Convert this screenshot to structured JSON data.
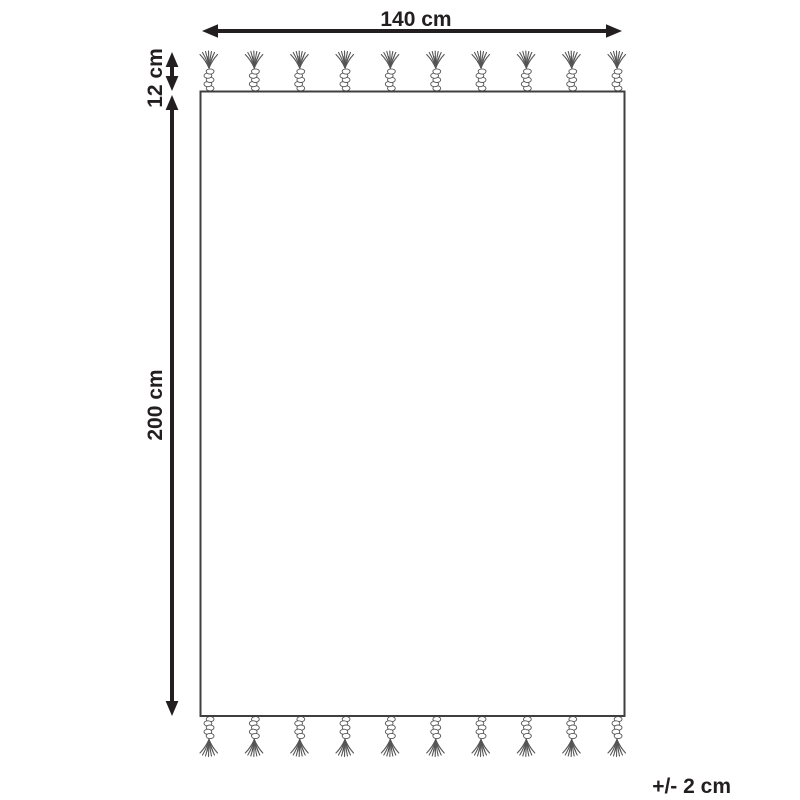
{
  "diagram": {
    "dimensions": {
      "width": "140 cm",
      "fringe_length": "12 cm",
      "height": "200 cm",
      "tolerance": "+/- 2 cm"
    },
    "fringe": {
      "top_count": 10,
      "bottom_count": 10
    },
    "colors": {
      "ink": "#231f20",
      "outline": "#3f3f3f",
      "tassel": "#555555",
      "background": "#ffffff"
    }
  }
}
